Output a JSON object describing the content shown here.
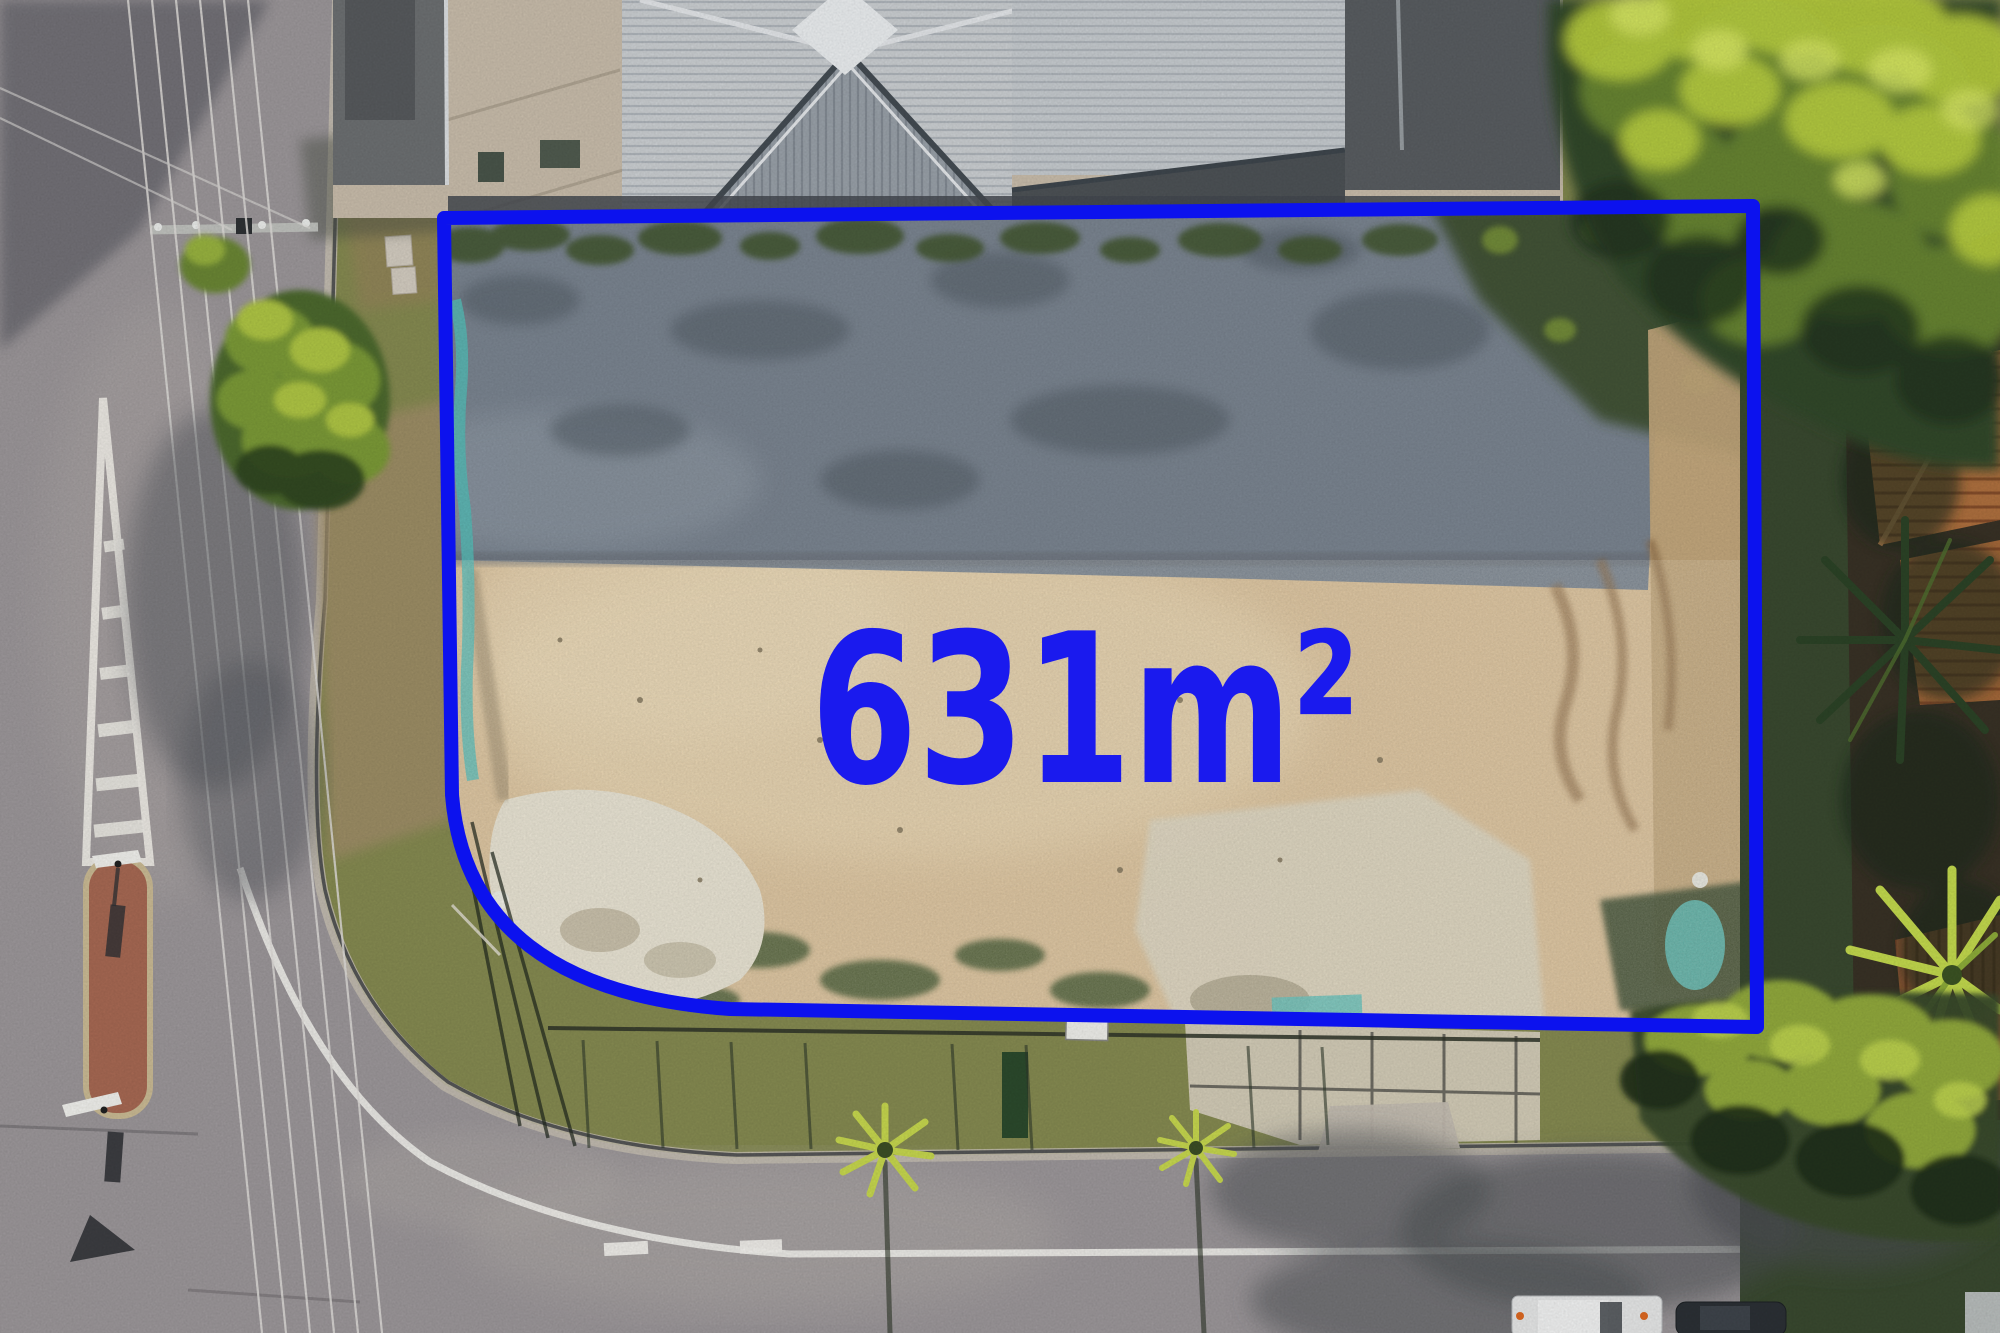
{
  "overlay": {
    "area_label": "631m²",
    "boundary_color": "#0c12ee",
    "label_color": "#1a1aee"
  }
}
